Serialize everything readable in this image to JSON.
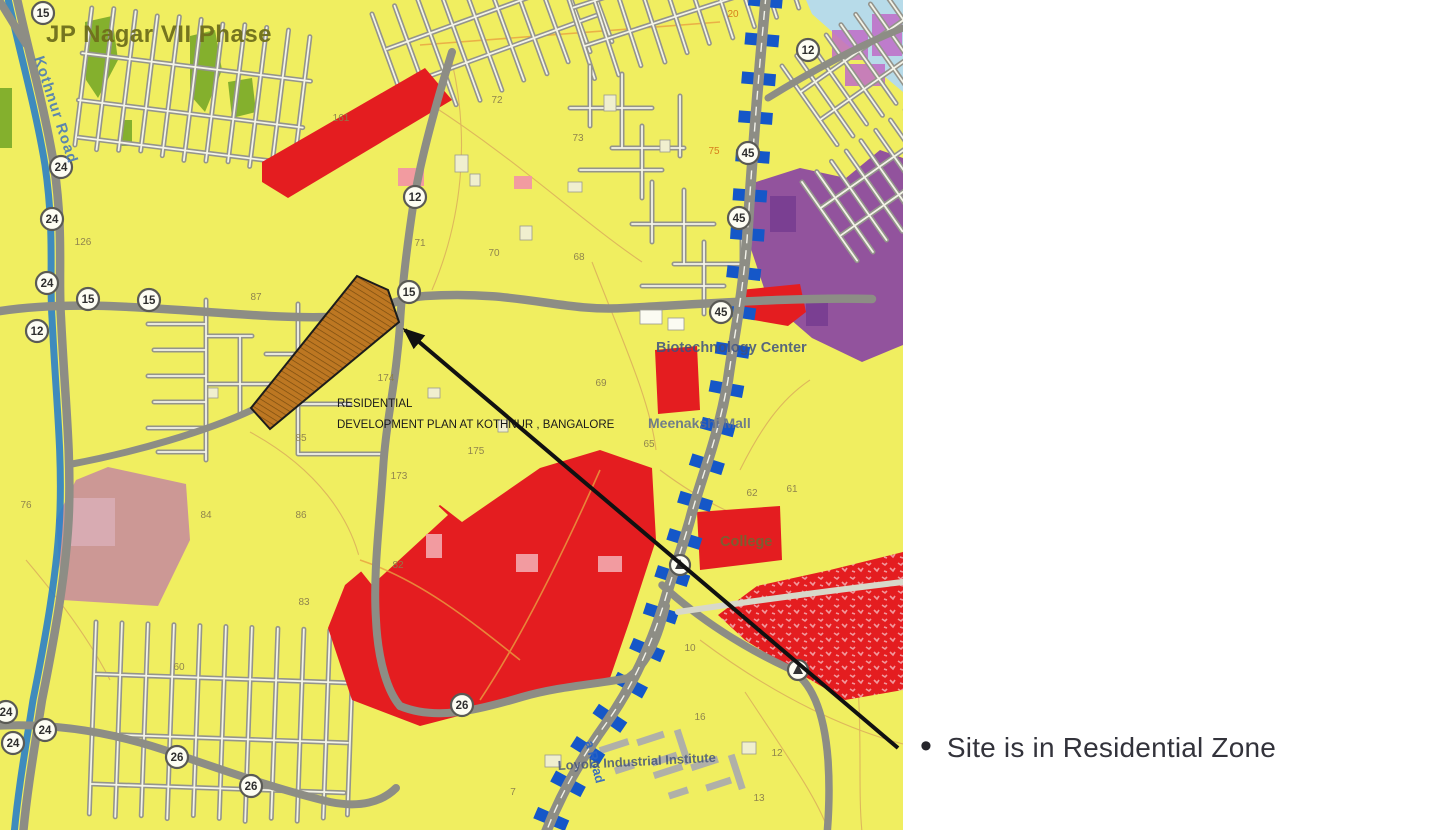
{
  "annotation": {
    "bullet": "•",
    "site_note": "Site is in Residential Zone"
  },
  "map": {
    "area_title": "JP Nagar VII Phase",
    "plan_label": {
      "line1": "RESIDENTIAL",
      "line2": "DEVELOPMENT PLAN AT KOTHNUR , BANGALORE"
    },
    "road_names": {
      "left_vertical": "Kothnur Road",
      "bottom_vertical": "a Road"
    },
    "poi": {
      "biotech": "Biotechnology Center",
      "mall": "Meenakshi Mall",
      "college": "College",
      "loyola": "Loyola Industrial Institute"
    },
    "badges": [
      "15",
      "24",
      "24",
      "24",
      "12",
      "15",
      "15",
      "15",
      "12",
      "12",
      "45",
      "45",
      "45",
      "24",
      "24",
      "24",
      "26",
      "26",
      "26"
    ],
    "parcels": [
      "161",
      "126",
      "72",
      "71",
      "70",
      "73",
      "68",
      "69",
      "65",
      "75",
      "20",
      "87",
      "174",
      "85",
      "175",
      "173",
      "82",
      "83",
      "86",
      "84",
      "76",
      "60",
      "62",
      "61",
      "10",
      "16",
      "12",
      "13",
      "7"
    ],
    "colors": {
      "residential_yellow": "#f0ee60",
      "commercial_red": "#e41d20",
      "public_purple": "#8c4aa0",
      "park_green": "#79aa28",
      "metro_blue": "#1557c8",
      "site_brown": "#bd7722",
      "water_blue": "#b7dbe9",
      "mixed_pink": "#c9909a",
      "canal_blue": "#2b80c8",
      "arrow_black": "#111111"
    }
  }
}
